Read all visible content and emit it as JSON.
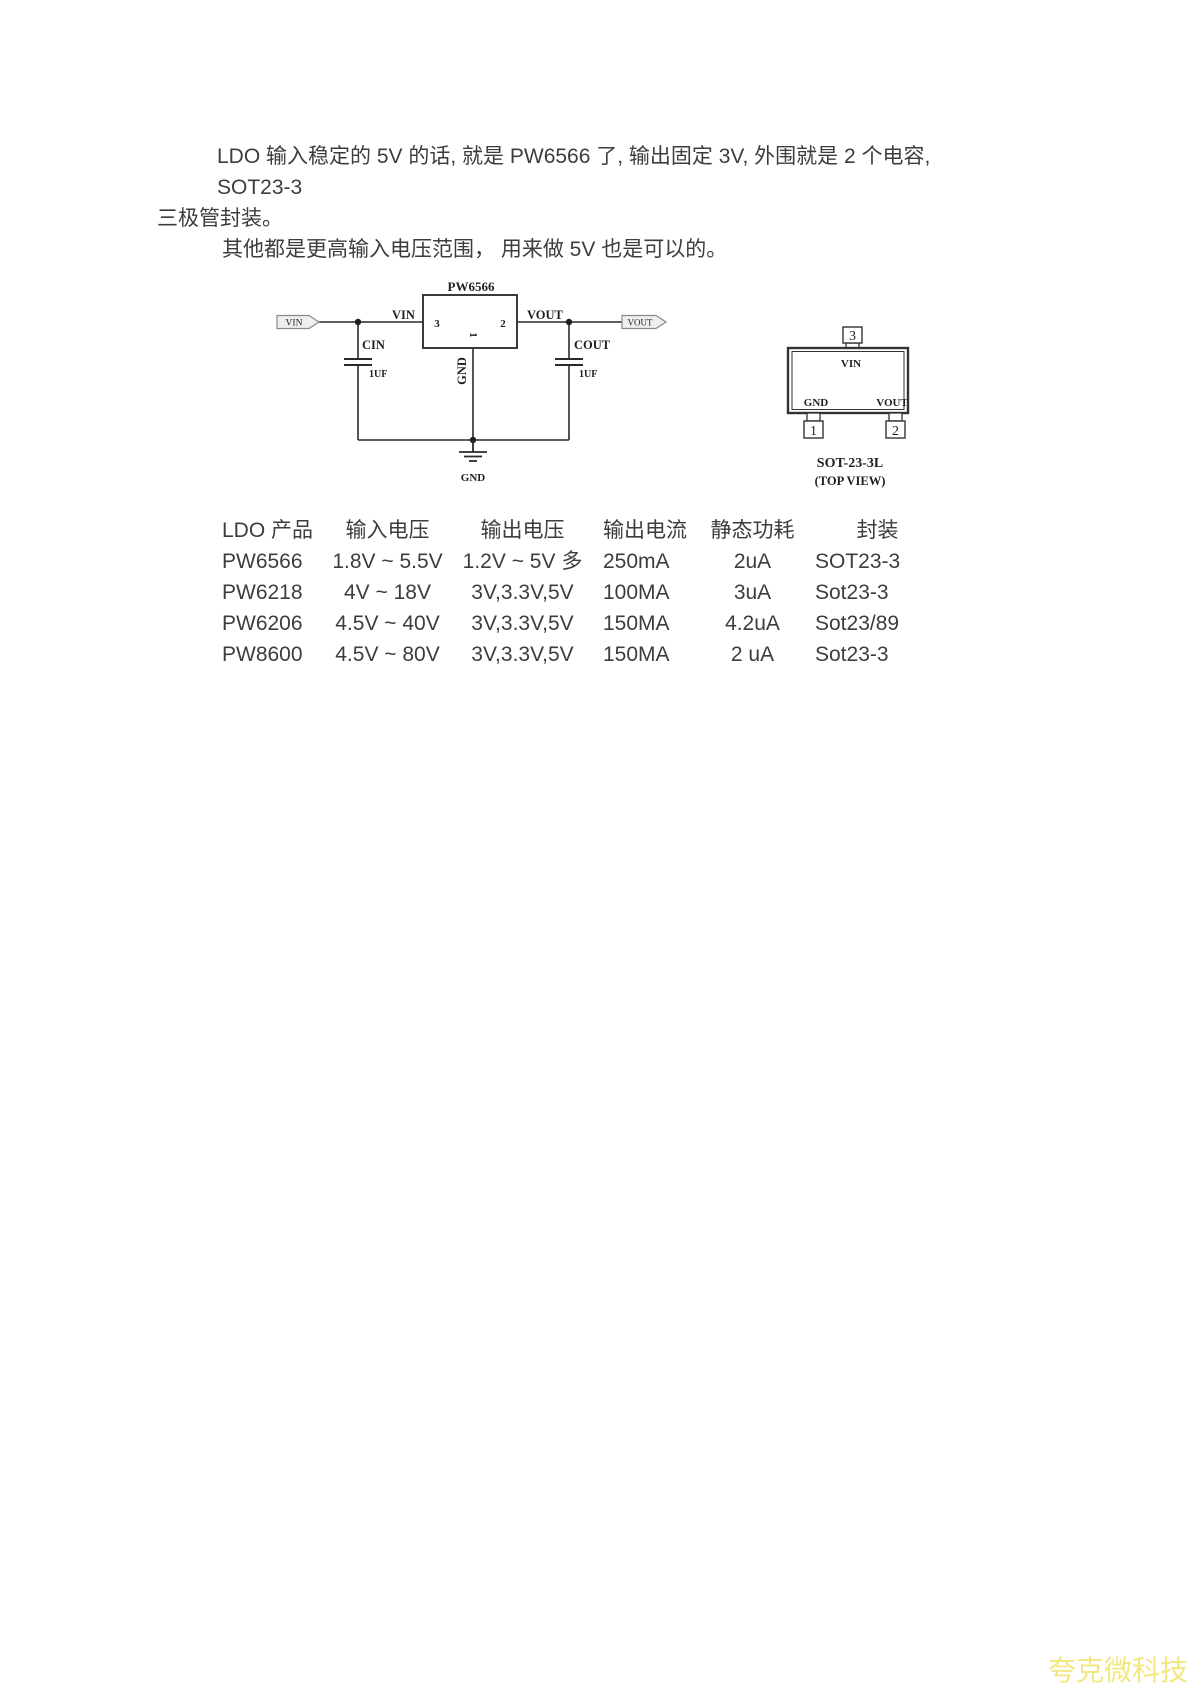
{
  "intro": {
    "line1": "LDO 输入稳定的 5V 的话, 就是 PW6566 了, 输出固定 3V, 外围就是 2 个电容, SOT23-3",
    "line2": "三极管封装。",
    "line3": "其他都是更高输入电压范围， 用来做 5V 也是可以的。"
  },
  "schematic": {
    "title": "PW6566",
    "vin_flag": "VIN",
    "vout_flag": "VOUT",
    "vin_net_label": "VIN",
    "vout_net_label": "VOUT",
    "pin3": "3",
    "pin2": "2",
    "pin1": "1",
    "gnd_pin_label": "GND",
    "cin_name": "CIN",
    "cin_value": "1UF",
    "cout_name": "COUT",
    "cout_value": "1UF",
    "ground_label": "GND"
  },
  "package": {
    "pin3": "3",
    "pin1": "1",
    "pin2": "2",
    "vin_label": "VIN",
    "gnd_label": "GND",
    "vout_label": "VOUT",
    "name": "SOT-23-3L",
    "view_note": "(TOP VIEW)"
  },
  "table": {
    "headers": [
      "LDO 产品",
      "输入电压",
      "输出电压",
      "输出电流",
      "静态功耗",
      "封装"
    ],
    "rows": [
      [
        "PW6566",
        "1.8V ~ 5.5V",
        "1.2V ~ 5V 多",
        "250mA",
        "2uA",
        "SOT23-3"
      ],
      [
        "PW6218",
        "4V ~ 18V",
        "3V,3.3V,5V",
        "100MA",
        "3uA",
        "Sot23-3"
      ],
      [
        "PW6206",
        "4.5V ~ 40V",
        "3V,3.3V,5V",
        "150MA",
        "4.2uA",
        "Sot23/89"
      ],
      [
        "PW8600",
        "4.5V ~ 80V",
        "3V,3.3V,5V",
        "150MA",
        "2 uA",
        "Sot23-3"
      ]
    ]
  },
  "watermark": {
    "text": "夸克微科技",
    "color": "#f2e87f"
  }
}
